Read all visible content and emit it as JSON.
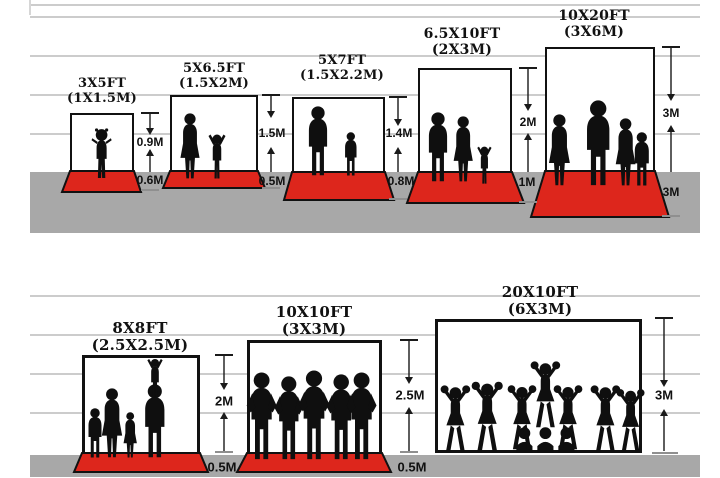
{
  "diagram_title": "Backdrop size comparison",
  "colors": {
    "mat_red": "#dd261c",
    "ground_gray": "#a8a8a8",
    "gridline_gray": "#cccccc",
    "silhouette_black": "#0f0f0f",
    "text_black": "#111111"
  },
  "sections": [
    {
      "name": "small-backdrops",
      "panels": [
        {
          "size_ft": "3X5FT",
          "size_m": "(1X1.5M)",
          "height": "0.9M",
          "floor": "0.6M",
          "figures": "toddler"
        },
        {
          "size_ft": "5X6.5FT",
          "size_m": "(1.5X2M)",
          "height": "1.5M",
          "floor": "0.5M",
          "figures": "woman-and-child"
        },
        {
          "size_ft": "5X7FT",
          "size_m": "(1.5X2.2M)",
          "height": "1.4M",
          "floor": "0.8M",
          "figures": "man-and-boy"
        },
        {
          "size_ft": "6.5X10FT",
          "size_m": "(2X3M)",
          "height": "2M",
          "floor": "1M",
          "figures": "family-of-three"
        },
        {
          "size_ft": "10X20FT",
          "size_m": "(3X6M)",
          "height": "3M",
          "floor": "3M",
          "figures": "family-of-four"
        }
      ]
    },
    {
      "name": "large-backdrops",
      "panels": [
        {
          "size_ft": "8X8FT",
          "size_m": "(2.5X2.5M)",
          "height": "2M",
          "floor": "0.5M",
          "figures": "family-group"
        },
        {
          "size_ft": "10X10FT",
          "size_m": "(3X3M)",
          "height": "2.5M",
          "floor": "0.5M",
          "figures": "five-athletes"
        },
        {
          "size_ft": "20X10FT",
          "size_m": "(6X3M)",
          "height": "3M",
          "floor": "",
          "figures": "cheerleading-squad"
        }
      ]
    }
  ]
}
